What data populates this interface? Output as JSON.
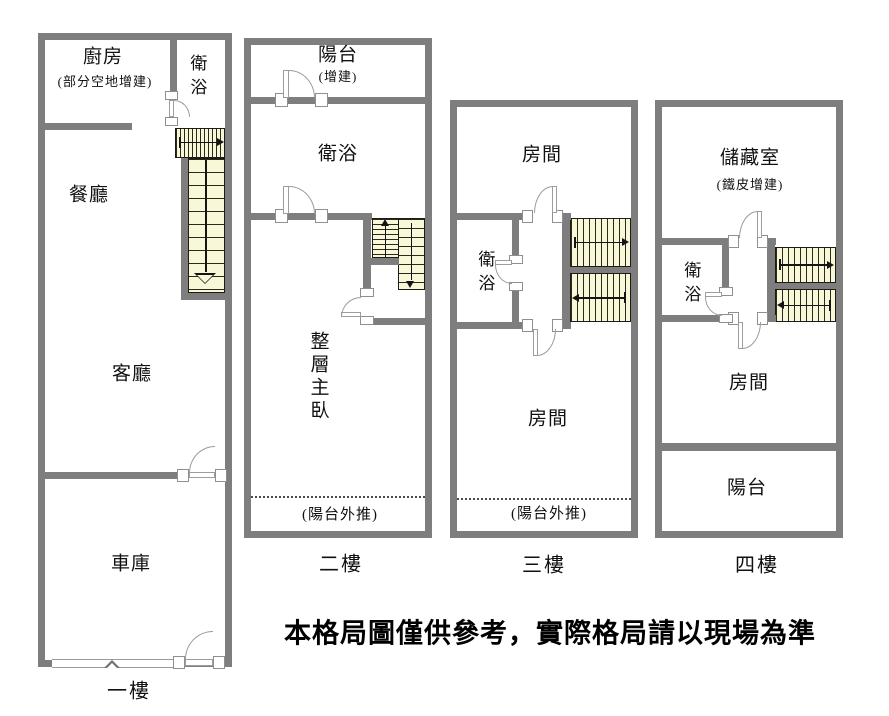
{
  "disclaimer": "本格局圖僅供參考，實際格局請以現場為準",
  "floors": [
    {
      "id": "floor-1",
      "label": "一樓",
      "rooms": {
        "kitchen": "廚房",
        "kitchen_note": "(部分空地增建)",
        "bath": "衛浴",
        "dining": "餐廳",
        "living": "客廳",
        "garage": "車庫"
      }
    },
    {
      "id": "floor-2",
      "label": "二樓",
      "rooms": {
        "balcony": "陽台",
        "balcony_note": "(增建)",
        "bath": "衛浴",
        "master": "整層主臥",
        "balcony_push": "(陽台外推)"
      }
    },
    {
      "id": "floor-3",
      "label": "三樓",
      "rooms": {
        "room_top": "房間",
        "bath": "衛浴",
        "room_bottom": "房間",
        "balcony_push": "(陽台外推)"
      }
    },
    {
      "id": "floor-4",
      "label": "四樓",
      "rooms": {
        "storage": "儲藏室",
        "storage_note": "(鐵皮增建)",
        "bath": "衛浴",
        "room": "房間",
        "balcony": "陽台"
      }
    }
  ],
  "colors": {
    "wall": "#7e7e7e",
    "stair_fill": "#f8f7d8",
    "door_arc": "#9b9b9b",
    "dash": "#4a4a4a",
    "text": "#111111"
  }
}
